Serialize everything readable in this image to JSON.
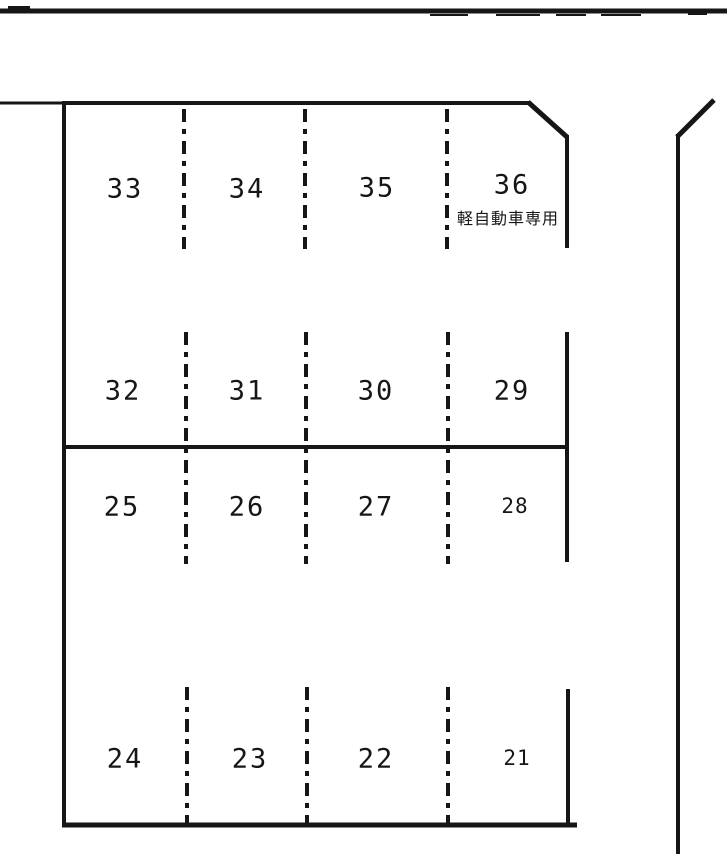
{
  "page": {
    "background_color": "#ffffff",
    "line_color": "#161616",
    "kind": "parking-lot-plan"
  },
  "map": {
    "rows": [
      {
        "stalls": [
          {
            "number": "33"
          },
          {
            "number": "34"
          },
          {
            "number": "35"
          },
          {
            "number": "36",
            "note": "軽自動車専用"
          }
        ]
      },
      {
        "stalls": [
          {
            "number": "32"
          },
          {
            "number": "31"
          },
          {
            "number": "30"
          },
          {
            "number": "29"
          }
        ]
      },
      {
        "stalls": [
          {
            "number": "25"
          },
          {
            "number": "26"
          },
          {
            "number": "27"
          },
          {
            "number": "28"
          }
        ]
      },
      {
        "stalls": [
          {
            "number": "24"
          },
          {
            "number": "23"
          },
          {
            "number": "22"
          },
          {
            "number": "21"
          }
        ]
      }
    ]
  }
}
